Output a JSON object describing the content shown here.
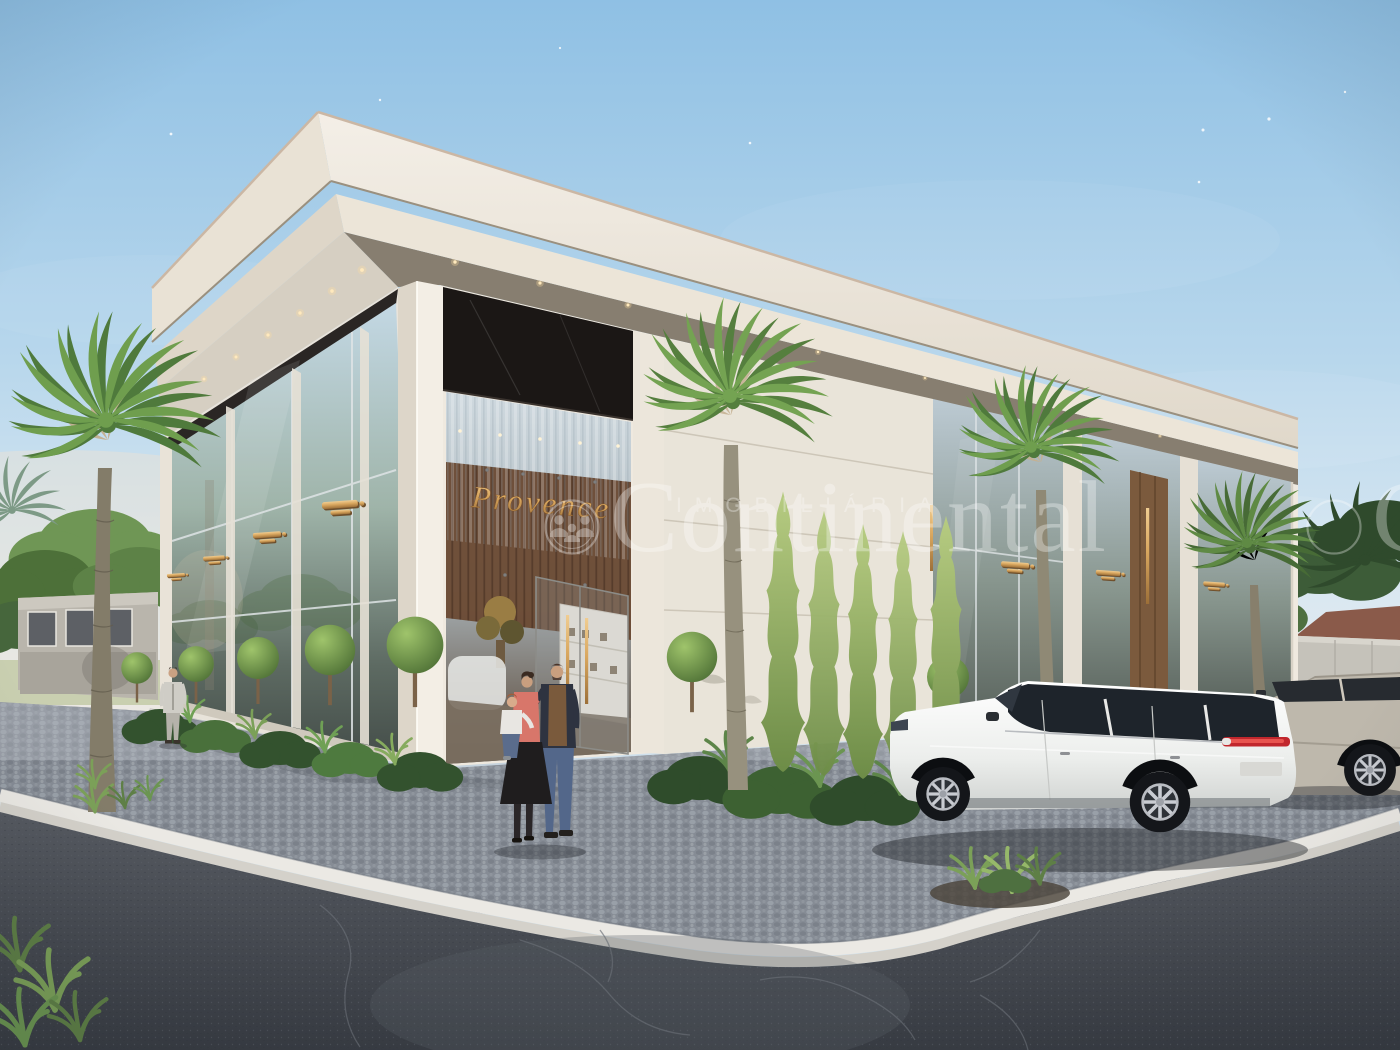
{
  "scene": {
    "type": "architectural-exterior-3d-render",
    "setting": "Modern single-storey luxury retail building on a cobblestone street corner at dusk",
    "signs": {
      "main_storefront": "Provence"
    },
    "watermark": {
      "small_caps": "IMOBILIÁRIA",
      "brand": "Continental"
    },
    "colors": {
      "sky_top": "#8fc0e4",
      "sky_horizon": "#e8edf0",
      "facade_white": "#efe9df",
      "fascia": "#f2ede4",
      "marble_frieze": "#1b1715",
      "signage_gold": "#d9a75f",
      "glass_reflection": "#b7c6cf",
      "cobblestone": "#8a9099",
      "asphalt": "#43474e",
      "curb_white": "#ebe9e4",
      "foliage_green": "#6f9e4e",
      "cypress_green": "#8fae62",
      "suv_white": "#f4f4f2",
      "suv_silver": "#beb8ac",
      "taillight_red": "#c1272d"
    },
    "vehicles": [
      "white luxury SUV parked in front",
      "silver SUV at right edge"
    ],
    "people": [
      "man in grey suit near left facade",
      "couple holding a toddler at the entrance"
    ],
    "landscaping": [
      "tall fan palm trees",
      "row of conical cypresses",
      "round topiary shrubs",
      "tropical planting beds",
      "grass tufts in curb planter"
    ]
  }
}
